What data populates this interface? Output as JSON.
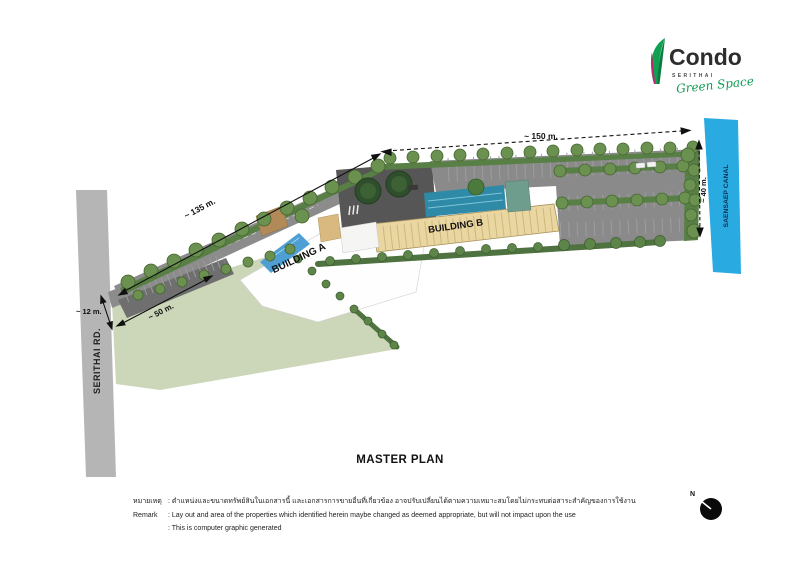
{
  "logo": {
    "brand": "Condo",
    "sub_brand": "SERITHAI",
    "tagline": "Green Space",
    "leaf_green": "#0ea152",
    "leaf_magenta": "#c2266d"
  },
  "site": {
    "road_label": "SERITHAI RD.",
    "canal_label": "SAENSAEP CANAL",
    "building_a": "BUILDING A",
    "building_b": "BUILDING B",
    "dim_top": "~ 150 m.",
    "dim_west": "~ 135 m.",
    "dim_lawn": "~ 50 m.",
    "dim_road": "~ 12 m.",
    "dim_canal": "~ 40 m."
  },
  "title": "MASTER PLAN",
  "remark": {
    "thai_label": "หมายเหตุ",
    "thai_text": ": ตำแหน่งและขนาดทรัพย์สินในเอกสารนี้ และเอกสารการขายอื่นที่เกี่ยวข้อง อาจปรับเปลี่ยนได้ตามความเหมาะสมโดยไม่กระทบต่อสาระสำคัญของการใช้งาน",
    "en_label": "Remark",
    "en_text": ": Lay out and area of the properties which identified herein maybe changed as deemed appropriate, but will not impact upon the use",
    "en_text2": ": This is computer graphic generated"
  },
  "compass": {
    "label": "N"
  },
  "colors": {
    "canal": "#29abe2",
    "road": "#b5b5b5",
    "asphalt": "#8a8a8a",
    "plaza": "#565656",
    "lawn": "#ccd6b8",
    "greenery": "#587f45",
    "tree": "#6a9150",
    "pool": "#2e8aa6",
    "pool_a": "#4d9fd4",
    "building_b_roof": "#e9d6a0",
    "building_a_roof": "#fefefe"
  }
}
